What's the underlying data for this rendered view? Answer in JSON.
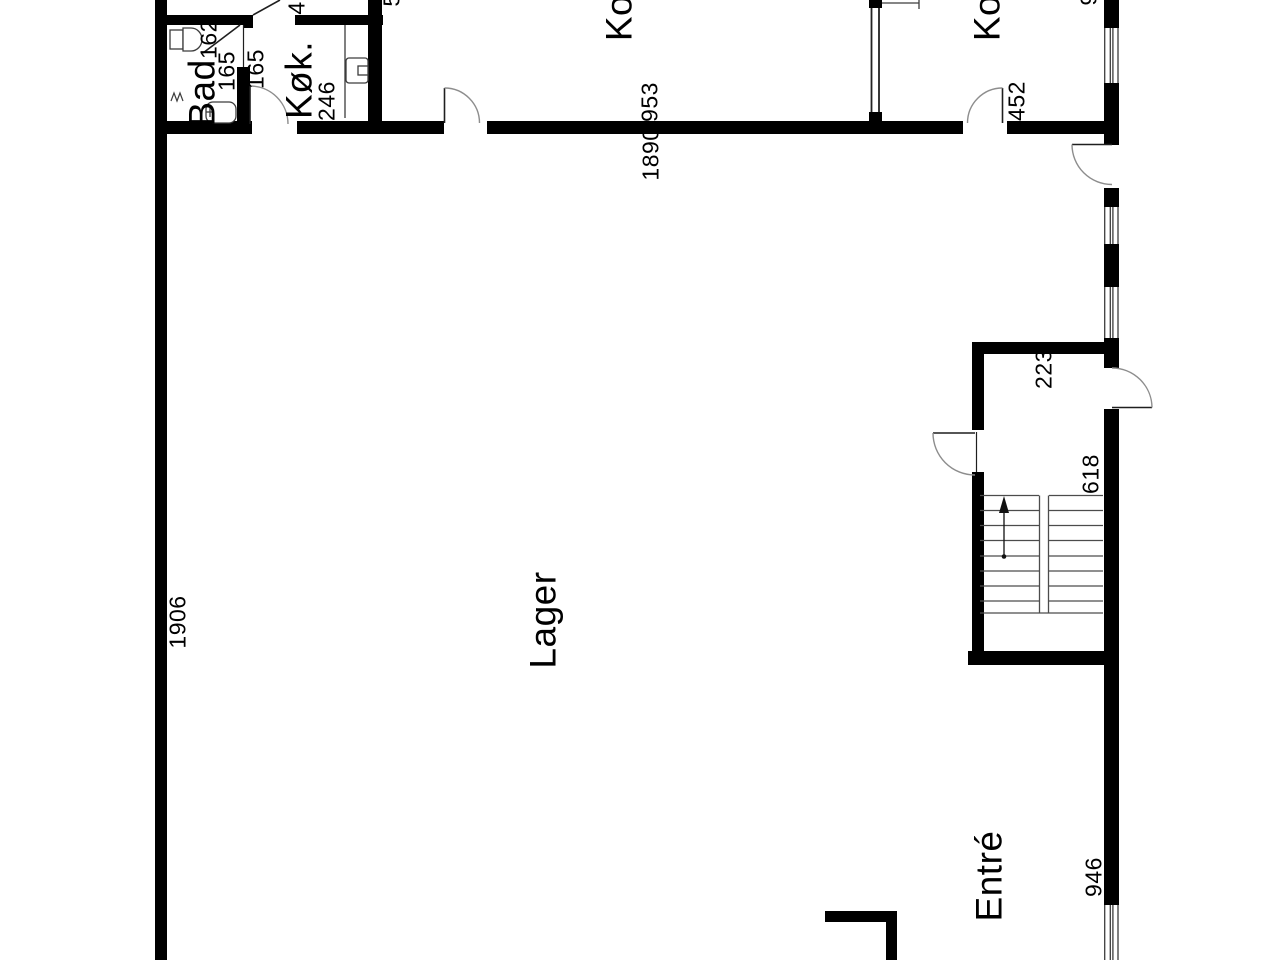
{
  "plan": {
    "type": "floor-plan",
    "language": "Danish",
    "colors": {
      "background": "#ffffff",
      "wall": "#000000",
      "thin_line": "#3c3c3c",
      "door_arc": "#8d8d8d"
    },
    "rooms": [
      {
        "id": "bad",
        "label": "Bad"
      },
      {
        "id": "kok",
        "label": "Køk."
      },
      {
        "id": "kontor-1",
        "label": "Ko"
      },
      {
        "id": "kontor-2",
        "label": "Ko"
      },
      {
        "id": "lager",
        "label": "Lager"
      },
      {
        "id": "entre",
        "label": "Entré"
      }
    ],
    "dimensions": [
      {
        "id": "dim-162",
        "text": "162"
      },
      {
        "id": "dim-165-left",
        "text": "165"
      },
      {
        "id": "dim-165-right",
        "text": "165"
      },
      {
        "id": "dim-246",
        "text": "246"
      },
      {
        "id": "dim-4-partial",
        "text": "4"
      },
      {
        "id": "dim-953",
        "text": "953"
      },
      {
        "id": "dim-1890",
        "text": "1890"
      },
      {
        "id": "dim-452",
        "text": "452"
      },
      {
        "id": "dim-1906",
        "text": "1906"
      },
      {
        "id": "dim-223",
        "text": "223"
      },
      {
        "id": "dim-618",
        "text": "618"
      },
      {
        "id": "dim-946",
        "text": "946"
      }
    ],
    "fragments": [
      {
        "id": "fragment-top-1",
        "text": "5"
      },
      {
        "id": "fragment-top-2",
        "text": "9"
      }
    ],
    "features": {
      "stair_flights": 2,
      "stair_treads": 8,
      "windows_right_wall": 4,
      "doors": 8
    }
  }
}
